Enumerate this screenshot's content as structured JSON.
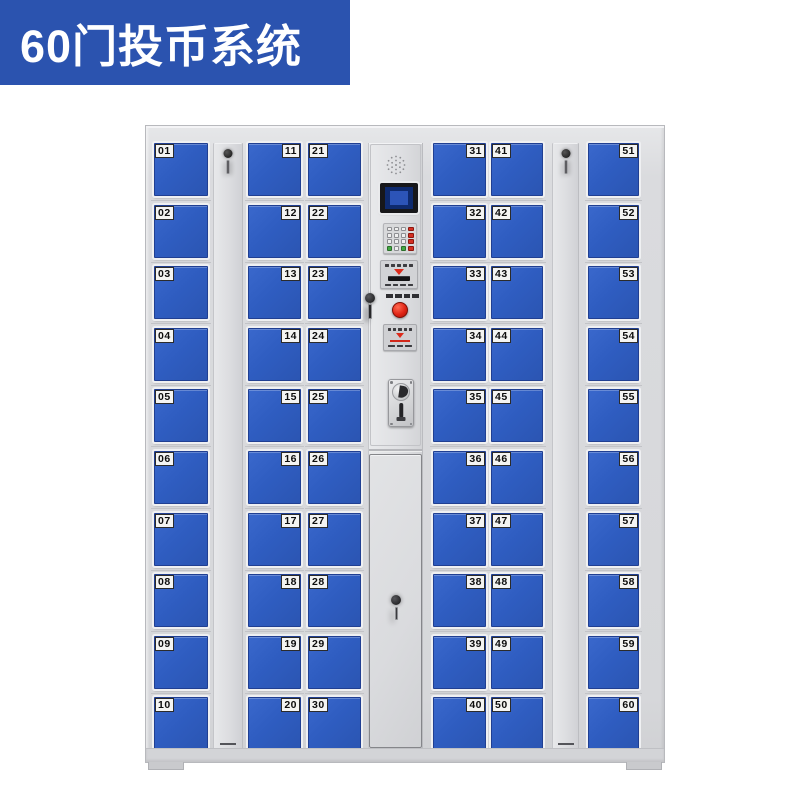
{
  "banner": {
    "title": "60门投币系统",
    "bg_color": "#2b53af",
    "text_color": "#ffffff"
  },
  "cabinet": {
    "door_count": 60,
    "colors": {
      "door_blue": "#2f5dc1",
      "frame_gray": "#d6d7da",
      "label_bg": "#f4f4f2",
      "label_text": "#0d0d0d",
      "button_red": "#e02415",
      "key_green": "#43a843",
      "lcd_navy": "#0e2a6e"
    },
    "columns": [
      {
        "type": "doors",
        "name": "door-column-1",
        "label_side": "left",
        "doors": [
          "01",
          "02",
          "03",
          "04",
          "05",
          "06",
          "07",
          "08",
          "09",
          "10"
        ]
      },
      {
        "type": "panel",
        "name": "side-lock-panel-left"
      },
      {
        "type": "doors",
        "name": "door-column-2",
        "label_side": "right",
        "doors": [
          "11",
          "12",
          "13",
          "14",
          "15",
          "16",
          "17",
          "18",
          "19",
          "20"
        ]
      },
      {
        "type": "doors",
        "name": "door-column-3",
        "label_side": "left",
        "doors": [
          "21",
          "22",
          "23",
          "24",
          "25",
          "26",
          "27",
          "28",
          "29",
          "30"
        ]
      },
      {
        "type": "control",
        "name": "control-column"
      },
      {
        "type": "doors",
        "name": "door-column-4",
        "label_side": "right",
        "doors": [
          "31",
          "32",
          "33",
          "34",
          "35",
          "36",
          "37",
          "38",
          "39",
          "40"
        ]
      },
      {
        "type": "doors",
        "name": "door-column-5",
        "label_side": "left",
        "doors": [
          "41",
          "42",
          "43",
          "44",
          "45",
          "46",
          "47",
          "48",
          "49",
          "50"
        ]
      },
      {
        "type": "panel",
        "name": "side-lock-panel-right"
      },
      {
        "type": "doors",
        "name": "door-column-6",
        "label_side": "right",
        "doors": [
          "51",
          "52",
          "53",
          "54",
          "55",
          "56",
          "57",
          "58",
          "59",
          "60"
        ]
      }
    ],
    "control": {
      "components": [
        "speaker-grille",
        "lcd-display",
        "numeric-keypad",
        "card-reader",
        "service-lock",
        "coin-return-button",
        "instruction-label",
        "coin-acceptor",
        "service-door"
      ],
      "keypad_pattern": [
        "wwwr",
        "wwwr",
        "wwwr",
        "gwgr"
      ]
    }
  }
}
